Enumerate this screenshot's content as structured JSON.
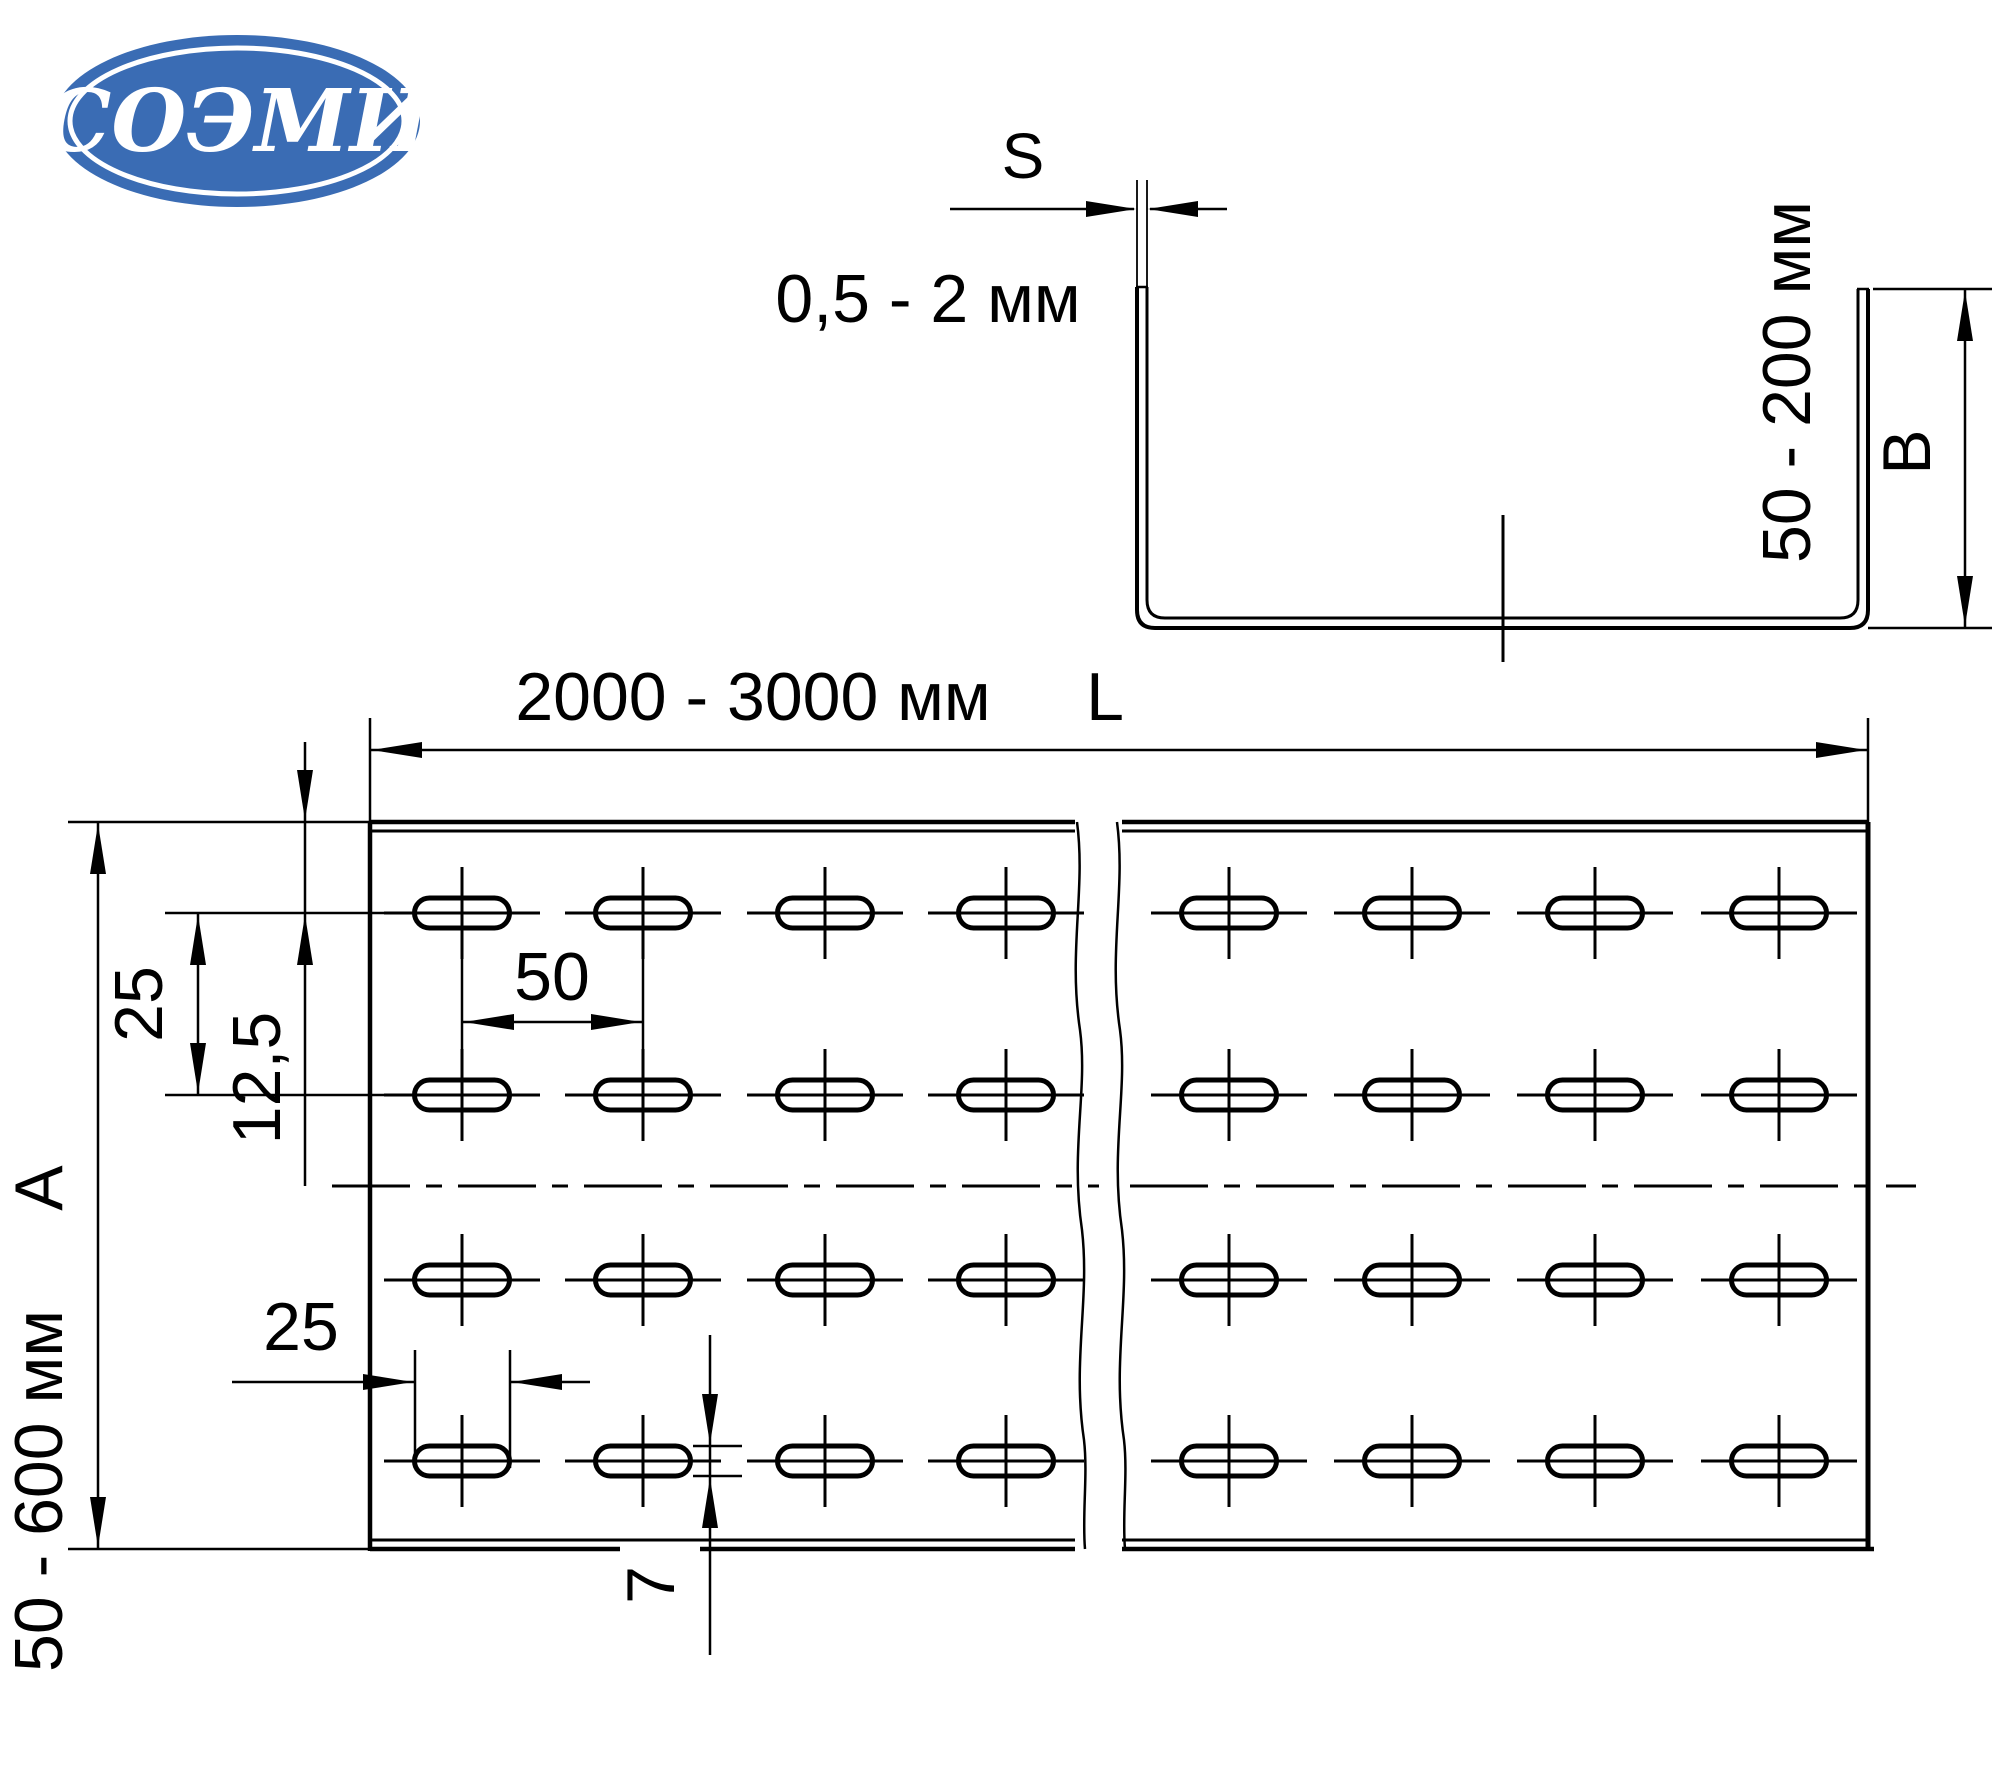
{
  "logo": {
    "text": "СОЭМИ",
    "bg_color": "#3a6cb4",
    "text_color": "#ffffff"
  },
  "profile_view": {
    "thickness_letter": "S",
    "thickness_range": "0,5 - 2 мм",
    "height_range": "50 - 200 мм",
    "height_letter": "B"
  },
  "plan_view": {
    "length_range": "2000 - 3000 мм",
    "length_letter": "L",
    "width_range": "50 - 600 мм",
    "width_letter": "A",
    "row_spacing": "25",
    "edge_offset": "12,5",
    "column_spacing": "50",
    "slot_length": "25",
    "slot_height": "7"
  },
  "hole_pattern": {
    "row_centers_y": [
      913,
      1095,
      1280,
      1461
    ],
    "left_piece_column_centers_x": [
      462,
      643,
      825,
      1006
    ],
    "right_piece_column_centers_x": [
      1229,
      1412,
      1595,
      1779
    ],
    "slot_width_px": 95,
    "slot_height_px": 30,
    "crosshair_h_halfspan": 78,
    "crosshair_v_halfspan": 46
  }
}
